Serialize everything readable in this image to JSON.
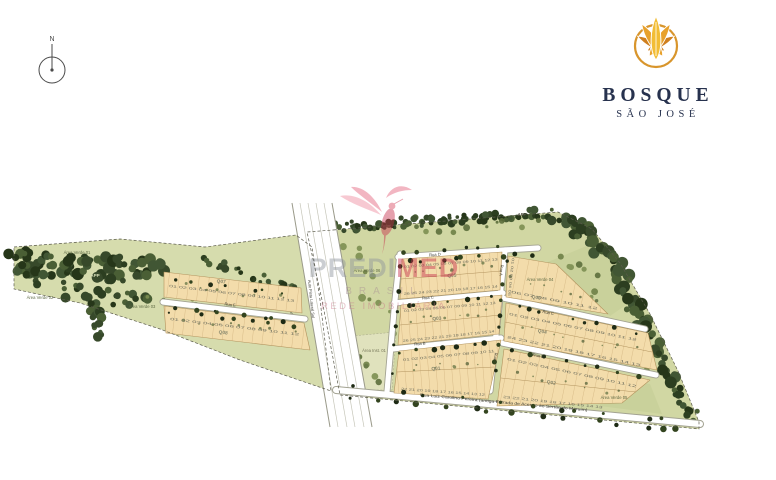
{
  "compass": {
    "north": "N"
  },
  "logo": {
    "name": "BOSQUE",
    "subname": "SÃO JOSÉ"
  },
  "watermark": {
    "brand_gray": "PREDI",
    "brand_red": "MED",
    "line2": "BRASIL",
    "line3": "REDE IMOBILIÁRIA"
  },
  "map": {
    "colors": {
      "lot": "#f3dcab",
      "lot_line": "#b2935e",
      "green_left": "#d6dcad",
      "green_main": "#d1d7a3",
      "green_patch": "#c9d19b",
      "inst": "#e0e2bd",
      "forest": "#36492a",
      "street_white": "#ffffff",
      "street_edge": "#a3a392",
      "boundary": "#5b5b4c",
      "label_green": "#5f6b45",
      "label_dark": "#3f3f35",
      "quadra": "#85856b",
      "number": "#6f6f5e",
      "watermark_pink": "#e4607a",
      "watermark_red": "#c62f4b",
      "watermark_gray": "#8d939c",
      "logo_gold": "#d8952c",
      "logo_navy": "#27324e"
    },
    "streets": {
      "rua_a": "Rua A",
      "rua_b": "Rua B",
      "rua_c": "Rua C",
      "rua_d": "Rua D",
      "rua_e": "Rua E",
      "marginal": "Via Marginal Prolong.",
      "highway": "Auto Pista Lateral Sul",
      "access_road": "Rua Luiz Carolino Pereira (antiga Estrada de Acesso ao Sertão do Maruim)"
    },
    "areas": {
      "app_top": "APP",
      "app_left": "APP",
      "verde_01": "Área Verde 01",
      "verde_02": "Área Verde 02",
      "verde_03": "Área Verde 03",
      "verde_04": "Área Verde 04",
      "verde_05": "Área Verde 05",
      "verde_06": "Área Verde 06",
      "inst_01": "Área Inst. 01"
    },
    "blocks": {
      "q01": {
        "label": "Q01",
        "row_top": "01 02 03 04 05 06 07 08 09 10 11",
        "row_bottom": "22 21 20 19 18 17 16 15 14 13 12"
      },
      "q02": {
        "label": "Q02",
        "row_top": "01 02 03 04 05 06 07 08 09 10 11 12",
        "row_bottom": "23 22 21 20 19 18 17 16 15 14 13"
      },
      "q03": {
        "label": "Q03",
        "row_top": "01 02 03 04 05 06 07 08 09 10 11 12 13",
        "row_bottom": "26 25 24 23 22 21 20 19 18 17 16 15 14"
      },
      "q04": {
        "label": "Q04",
        "row_top": "01 02 03 04 05 06 07 08 09 10 11 12",
        "row_bottom": "24 23 22 21 20 19 18 17 16 15 14 13"
      },
      "q05": {
        "label": "Q05",
        "row_top": "01 02 03 04 05 06 07 08 09 10 11 12 13",
        "row_bottom": "26 25 24 23 22 21 20 19 18 17 16 15 14"
      },
      "q06": {
        "label": "Q06",
        "row_top": "01 02 03 04 05",
        "row_bottom": "06 07 08 09 10 11 12"
      },
      "q07": {
        "label": "Q07",
        "row_top": "01 02 03 04 05 06 07 08 09 10 11 12 13"
      },
      "q08": {
        "label": "Q08",
        "row_top": "01 02 03 04 05 06 07 08 09 10 11 12"
      }
    }
  }
}
